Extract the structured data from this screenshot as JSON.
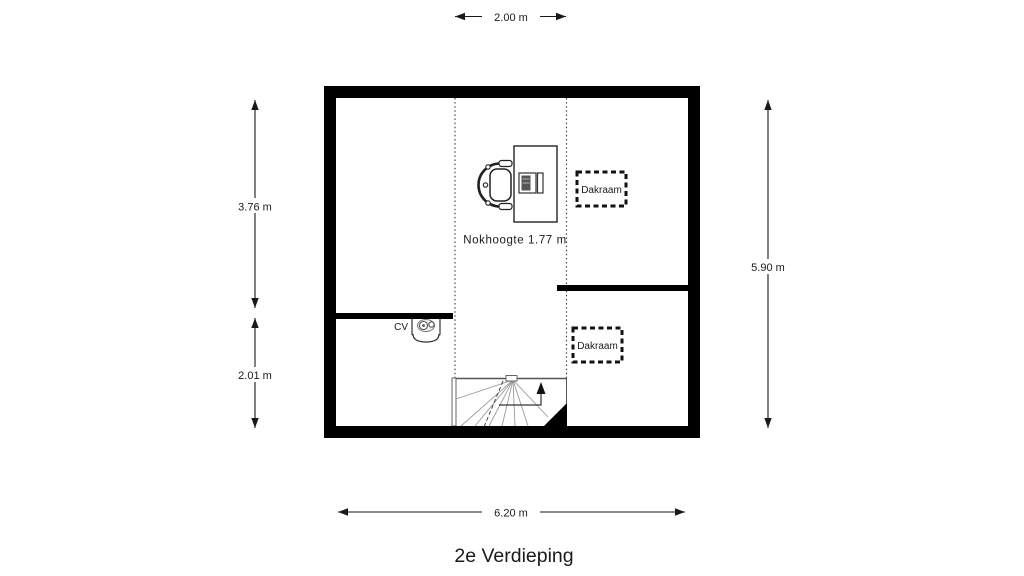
{
  "colors": {
    "background": "#ffffff",
    "walls": "#000000",
    "lines": "#4a4a4a",
    "stair_treads": "#9a9a9a",
    "text": "#1a1a1a"
  },
  "plan": {
    "title": "2e Verdieping",
    "ridge_height": "Nokhoogte 1.77 m",
    "boiler_label": "CV",
    "roof_windows": [
      {
        "label": "Dakraam"
      },
      {
        "label": "Dakraam"
      }
    ],
    "dimensions": {
      "top": "2.00 m",
      "left_upper": "3.76 m",
      "left_lower": "2.01 m",
      "right": "5.90 m",
      "bottom": "6.20 m"
    },
    "icons": {
      "stairs_direction": "triangle-up-arrow",
      "boiler": "cv-boiler-top-view",
      "workstation": "desk-chair-computer"
    }
  }
}
